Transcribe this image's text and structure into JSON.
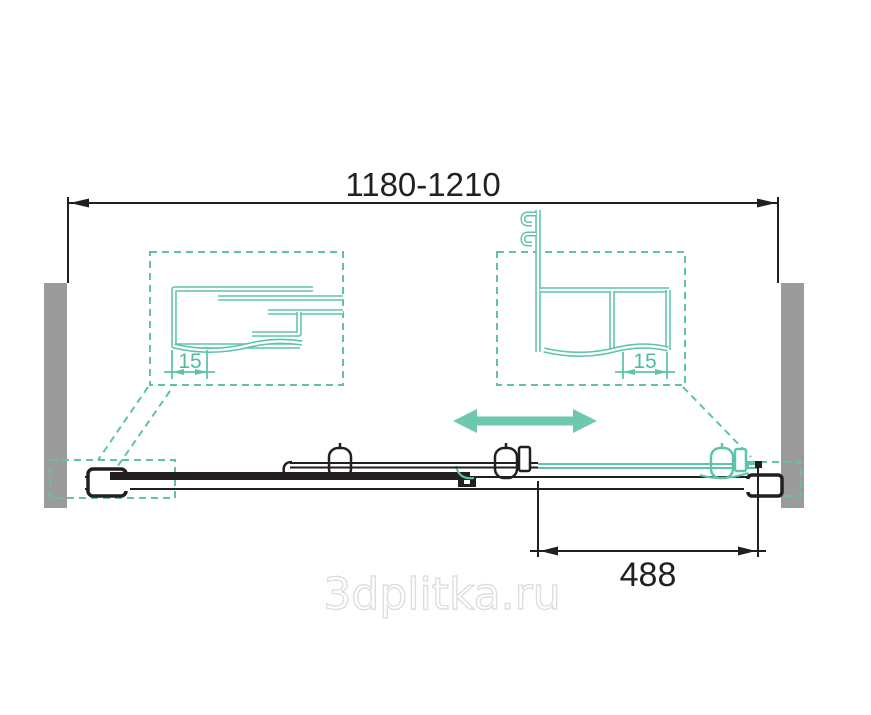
{
  "drawing": {
    "overall_width_label": "1180-1210",
    "left_detail": {
      "gap_label": "15"
    },
    "right_detail": {
      "gap_label": "15"
    },
    "opening_width_label": "488",
    "watermark": "3dplitka.ru",
    "colors": {
      "teal": "#5FC3AB",
      "wall_gray": "#9B9B9B",
      "line_black": "#231F20",
      "watermark_gray": "#DEDEDE"
    }
  }
}
